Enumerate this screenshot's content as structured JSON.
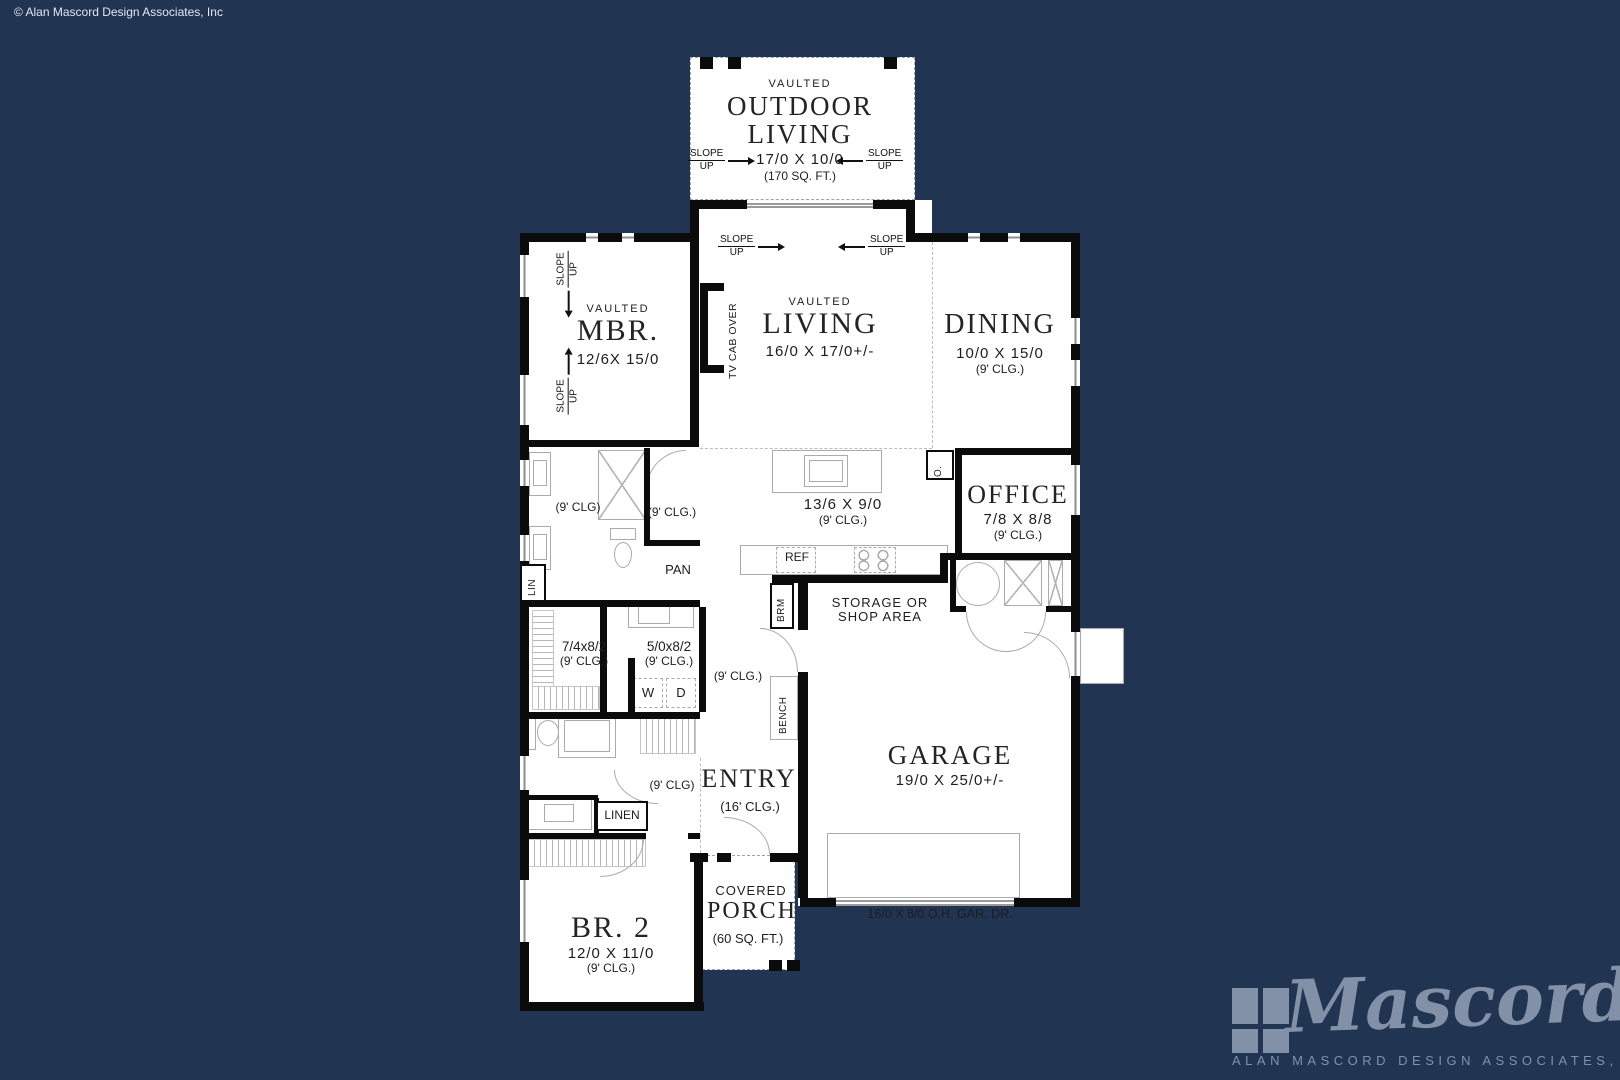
{
  "meta": {
    "copyright": "© Alan Mascord Design Associates, Inc"
  },
  "colors": {
    "background": "#213452",
    "walls": "#0b0b0b",
    "logo": "#8391a8"
  },
  "shared": {
    "slope_line1": "SLOPE",
    "slope_line2": "UP"
  },
  "outdoor_living": {
    "vaulted": "VAULTED",
    "name": "OUTDOOR LIVING",
    "dims": "17/0 X 10/0",
    "area": "(170 SQ. FT.)"
  },
  "living": {
    "vaulted": "VAULTED",
    "name": "LIVING",
    "dims": "16/0 X 17/0+/-",
    "tv_cab": "TV CAB OVER"
  },
  "mbr": {
    "vaulted": "VAULTED",
    "name": "MBR.",
    "dims": "12/6X 15/0"
  },
  "dining": {
    "name": "DINING",
    "dims": "10/0 X 15/0",
    "clg": "(9' CLG.)"
  },
  "office": {
    "name": "OFFICE",
    "dims": "7/8 X 8/8",
    "clg": "(9' CLG.)"
  },
  "kitchen": {
    "dims": "13/6 X 9/0",
    "clg": "(9' CLG.)",
    "ref": "REF",
    "oven": "O."
  },
  "master_bath": {
    "clg_left": "(9' CLG)",
    "clg_right": "(9' CLG.)",
    "pantry": "PAN",
    "linen": "LIN"
  },
  "closet": {
    "dims": "7/4x8/2",
    "clg": "(9' CLG.)"
  },
  "utility": {
    "dims": "5/0x8/2",
    "clg": "(9' CLG.)",
    "washer": "W",
    "dryer": "D"
  },
  "hall": {
    "clg": "(9' CLG.)"
  },
  "mud": {
    "bench": "BENCH",
    "broom": "BRM"
  },
  "garage": {
    "name": "GARAGE",
    "dims": "19/0 X 25/0+/-",
    "door": "16/0 X 8/0 O.H. GAR. DR.",
    "storage_line1": "STORAGE OR",
    "storage_line2": "SHOP AREA"
  },
  "entry": {
    "name": "ENTRY",
    "clg": "(16' CLG.)",
    "hall_clg": "(9' CLG)"
  },
  "linen_closet": {
    "name": "LINEN"
  },
  "br2": {
    "name": "BR. 2",
    "dims": "12/0 X 11/0",
    "clg": "(9' CLG.)"
  },
  "porch": {
    "line1": "COVERED",
    "line2": "PORCH",
    "area": "(60 SQ. FT.)"
  },
  "logo": {
    "script": "Mascord",
    "subtitle": "ALAN MASCORD DESIGN ASSOCIATES, INC."
  }
}
